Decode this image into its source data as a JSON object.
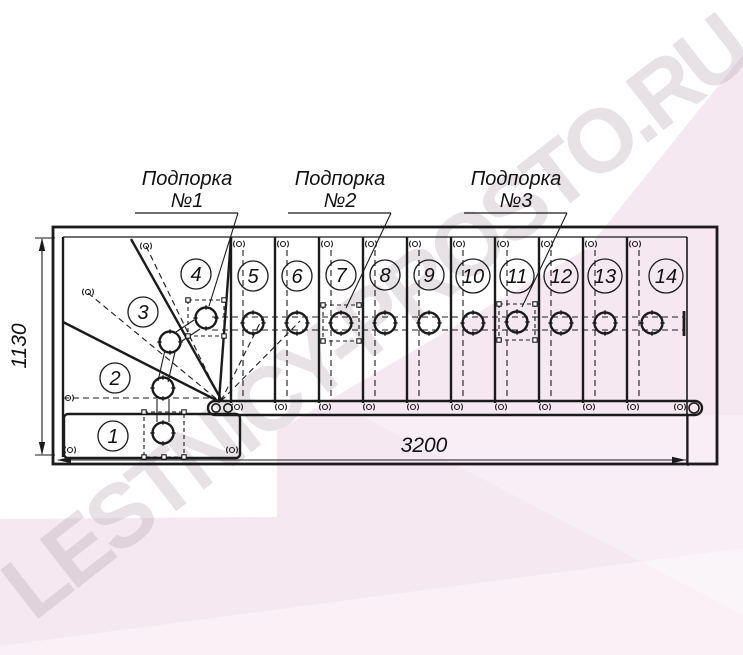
{
  "watermark": {
    "text": "LESTNICY-PROSTO.RU"
  },
  "plan": {
    "dim_width": "3200",
    "dim_height": "1130",
    "supports": [
      {
        "line1": "Подпорка",
        "line2": "№1"
      },
      {
        "line1": "Подпорка",
        "line2": "№2"
      },
      {
        "line1": "Подпорка",
        "line2": "№3"
      }
    ],
    "steps": [
      {
        "label": "1"
      },
      {
        "label": "2"
      },
      {
        "label": "3"
      },
      {
        "label": "4"
      },
      {
        "label": "5"
      },
      {
        "label": "6"
      },
      {
        "label": "7"
      },
      {
        "label": "8"
      },
      {
        "label": "9"
      },
      {
        "label": "10"
      },
      {
        "label": "11"
      },
      {
        "label": "12"
      },
      {
        "label": "13"
      },
      {
        "label": "14"
      }
    ],
    "colors": {
      "line": "#1b1b1b",
      "background_accent": "#f6e8f1",
      "watermark": "#b2a7b0"
    }
  }
}
